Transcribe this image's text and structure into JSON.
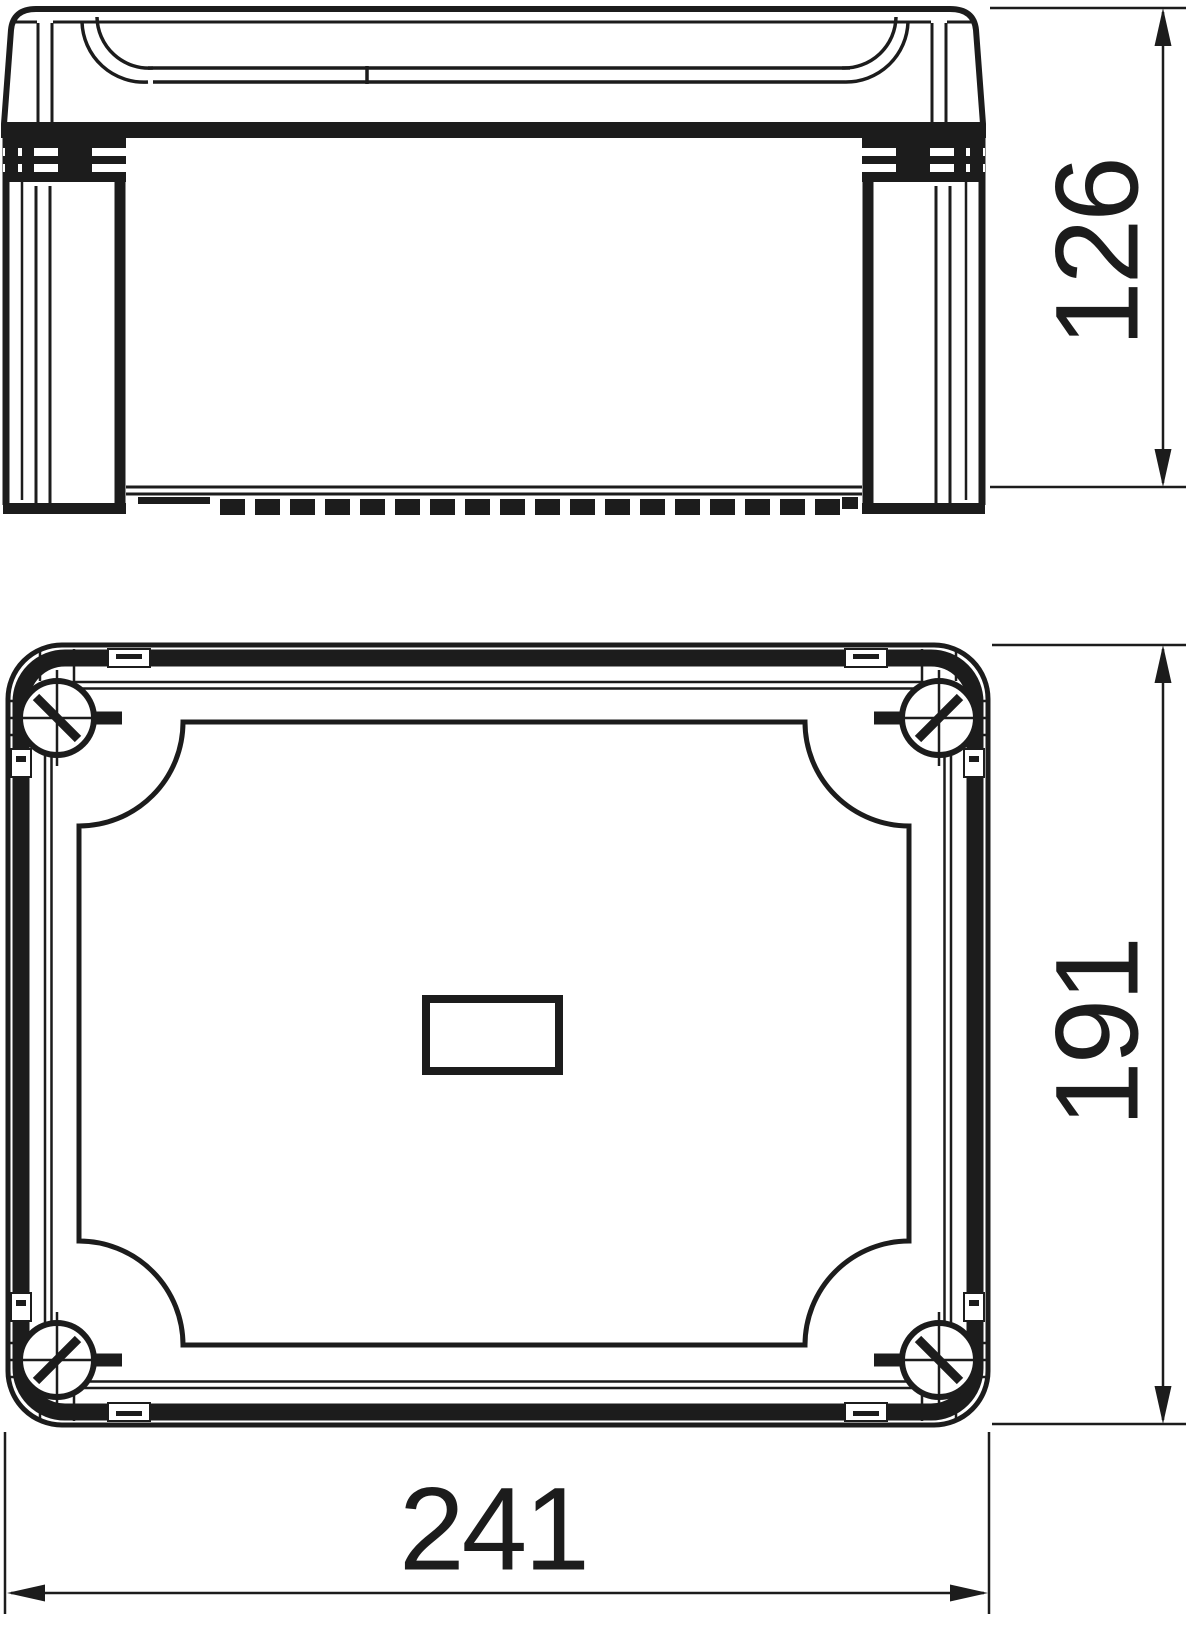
{
  "colors": {
    "line": "#1c1c1c",
    "background": "#ffffff"
  },
  "dimensions": {
    "side_height": {
      "label": "126"
    },
    "plan_height": {
      "label": "191"
    },
    "plan_width": {
      "label": "241"
    }
  }
}
